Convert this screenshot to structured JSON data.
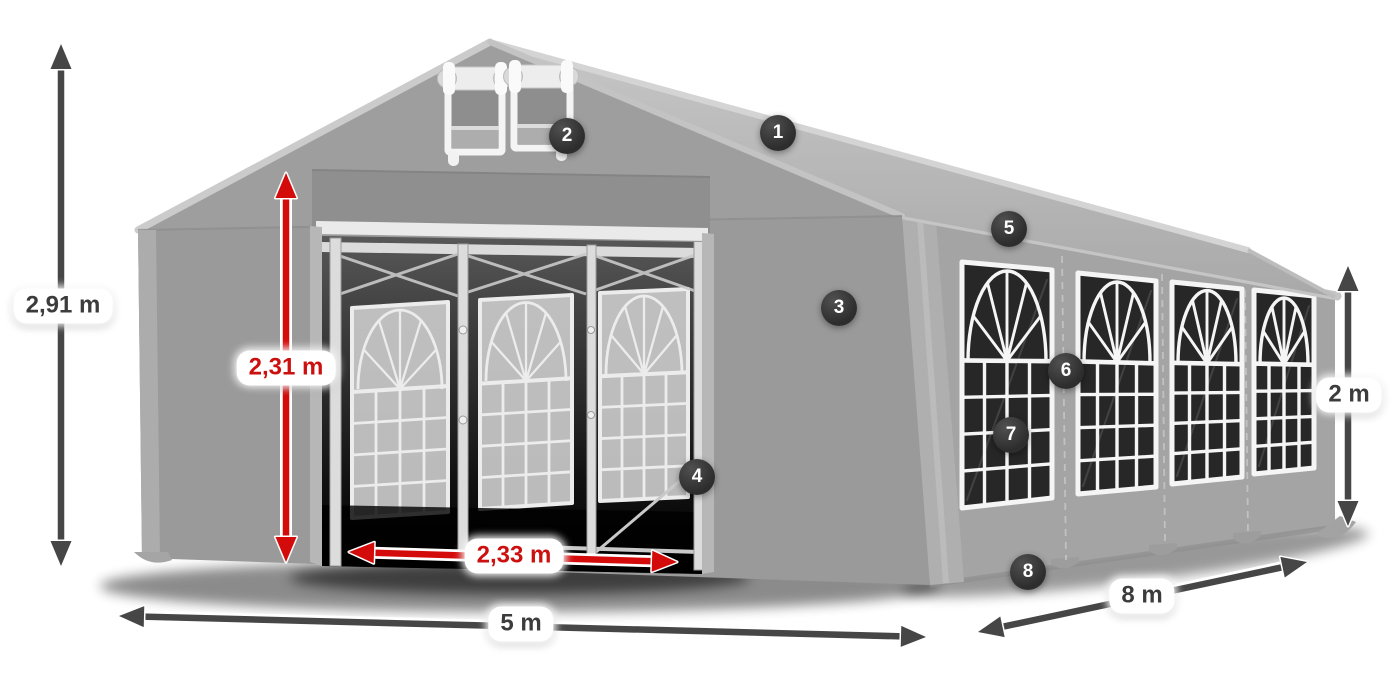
{
  "diagram": {
    "subject": "party-tent-dimensions",
    "dimension_labels": [
      {
        "id": "total-height",
        "text": "2,91 m",
        "color_style": "dark",
        "arrow": {
          "x1": 61,
          "y1": 44,
          "x2": 61,
          "y2": 566
        },
        "label": {
          "cx": 63,
          "cy": 306
        }
      },
      {
        "id": "entrance-height",
        "text": "2,31 m",
        "color_style": "red",
        "arrow": {
          "x1": 286,
          "y1": 173,
          "x2": 286,
          "y2": 562
        },
        "label": {
          "cx": 286,
          "cy": 368
        }
      },
      {
        "id": "entrance-width",
        "text": "2,33 m",
        "color_style": "red",
        "arrow": {
          "x1": 349,
          "y1": 552,
          "x2": 677,
          "y2": 562
        },
        "label": {
          "cx": 514,
          "cy": 556
        }
      },
      {
        "id": "front-width",
        "text": "5 m",
        "color_style": "dark",
        "arrow": {
          "x1": 119,
          "y1": 616,
          "x2": 926,
          "y2": 637
        },
        "label": {
          "cx": 521,
          "cy": 624
        }
      },
      {
        "id": "side-length",
        "text": "8 m",
        "color_style": "dark",
        "arrow": {
          "x1": 978,
          "y1": 632,
          "x2": 1307,
          "y2": 562
        },
        "label": {
          "cx": 1142,
          "cy": 596
        }
      },
      {
        "id": "side-height",
        "text": "2 m",
        "color_style": "dark",
        "arrow": {
          "x1": 1348,
          "y1": 266,
          "x2": 1348,
          "y2": 526
        },
        "label": {
          "cx": 1349,
          "cy": 395
        }
      }
    ],
    "hotspots": [
      {
        "number": "1",
        "cx": 778,
        "cy": 133
      },
      {
        "number": "2",
        "cx": 567,
        "cy": 136
      },
      {
        "number": "3",
        "cx": 839,
        "cy": 308
      },
      {
        "number": "4",
        "cx": 697,
        "cy": 477
      },
      {
        "number": "5",
        "cx": 1009,
        "cy": 229
      },
      {
        "number": "6",
        "cx": 1066,
        "cy": 371
      },
      {
        "number": "7",
        "cx": 1011,
        "cy": 435
      },
      {
        "number": "8",
        "cx": 1028,
        "cy": 572
      }
    ],
    "colors": {
      "red_arrow": "#d40b0b",
      "red_text": "#cc0f0f",
      "dark_arrow": "#464646",
      "dark_text": "#3c3c3c",
      "badge_bg": "#2d2d2d",
      "badge_text": "#ffffff",
      "label_bg": "#ffffff"
    }
  }
}
